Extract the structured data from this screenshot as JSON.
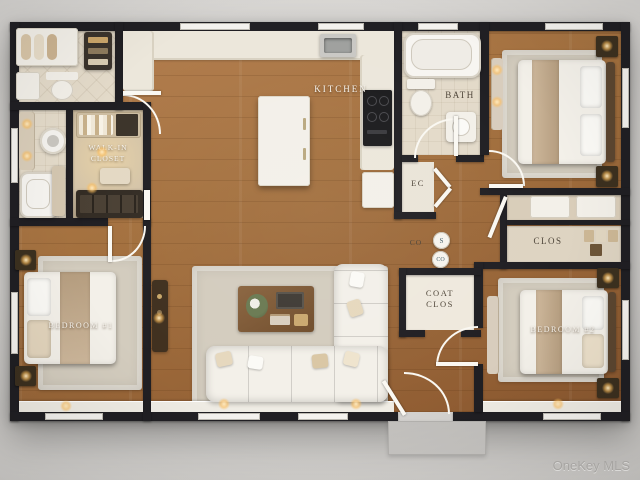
{
  "page": {
    "watermark": "OneKey MLS"
  },
  "rooms": {
    "kitchen": {
      "label": "KITCHEN"
    },
    "bath": {
      "label": "BATH"
    },
    "walk_in_closet": {
      "label_line1": "WALK-IN",
      "label_line2": "CLOSET"
    },
    "electrical_closet": {
      "label": "EC"
    },
    "coat_closet": {
      "label_line1": "COAT",
      "label_line2": "CLOS"
    },
    "closet": {
      "label": "CLOS"
    },
    "bedroom_1": {
      "label": "BEDROOM #1"
    },
    "bedroom_2": {
      "label": "BEDROOM #2"
    }
  },
  "detectors": {
    "co_annotation": "CO",
    "smoke_symbol": "S",
    "co_symbol": "CO"
  },
  "colors": {
    "background": "#d8d6d3",
    "wall": "#201f23",
    "wood": "#a4713f",
    "wood_dark": "#8c5930",
    "tile": "#e3dac9",
    "closet_floor": "#d3c3a8",
    "rug": "#d3ccbe",
    "furniture_white": "#f3f0e9",
    "accent_tan": "#c7b197",
    "counter": "#ece7db",
    "cooktop": "#1b1b1d",
    "label_light": "#f7f4ee",
    "label_dark": "#4e4539",
    "detector_text": "#3e5a66",
    "watermark": "#a5a3a0",
    "stoop": "#c7c5c2"
  }
}
